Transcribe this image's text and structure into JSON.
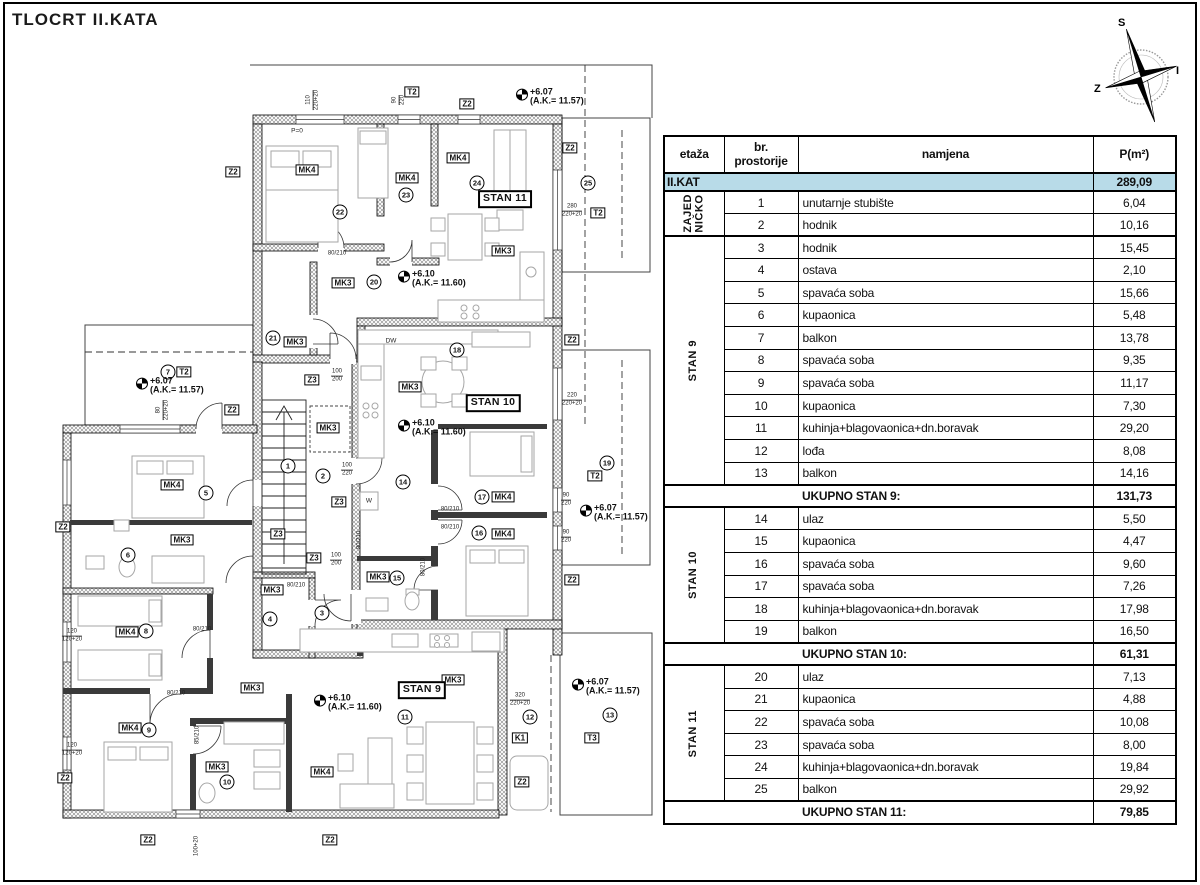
{
  "title": "TLOCRT II.KATA",
  "compass": {
    "north": "S",
    "east": "I",
    "west": "Z"
  },
  "table": {
    "header": {
      "col1": "etaža",
      "col2": "br.\nprostorije",
      "col3": "namjena",
      "col4": "P(m²)"
    },
    "floor_total": {
      "label": "II.KAT",
      "value": "289,09"
    },
    "groups": [
      {
        "label": "ZAJED\nNIČKO",
        "rows": [
          [
            "1",
            "unutarnje stubište",
            "6,04"
          ],
          [
            "2",
            "hodnik",
            "10,16"
          ]
        ]
      },
      {
        "label": "STAN 9",
        "rows": [
          [
            "3",
            "hodnik",
            "15,45"
          ],
          [
            "4",
            "ostava",
            "2,10"
          ],
          [
            "5",
            "spavaća soba",
            "15,66"
          ],
          [
            "6",
            "kupaonica",
            "5,48"
          ],
          [
            "7",
            "balkon",
            "13,78"
          ],
          [
            "8",
            "spavaća soba",
            "9,35"
          ],
          [
            "9",
            "spavaća soba",
            "11,17"
          ],
          [
            "10",
            "kupaonica",
            "7,30"
          ],
          [
            "11",
            "kuhinja+blagovaonica+dn.boravak",
            "29,20"
          ],
          [
            "12",
            "lođa",
            "8,08"
          ],
          [
            "13",
            "balkon",
            "14,16"
          ]
        ],
        "total_label": "UKUPNO STAN 9:",
        "total": "131,73"
      },
      {
        "label": "STAN 10",
        "rows": [
          [
            "14",
            "ulaz",
            "5,50"
          ],
          [
            "15",
            "kupaonica",
            "4,47"
          ],
          [
            "16",
            "spavaća soba",
            "9,60"
          ],
          [
            "17",
            "spavaća soba",
            "7,26"
          ],
          [
            "18",
            "kuhinja+blagovaonica+dn.boravak",
            "17,98"
          ],
          [
            "19",
            "balkon",
            "16,50"
          ]
        ],
        "total_label": "UKUPNO STAN 10:",
        "total": "61,31"
      },
      {
        "label": "STAN 11",
        "rows": [
          [
            "20",
            "ulaz",
            "7,13"
          ],
          [
            "21",
            "kupaonica",
            "4,88"
          ],
          [
            "22",
            "spavaća soba",
            "10,08"
          ],
          [
            "23",
            "spavaća soba",
            "8,00"
          ],
          [
            "24",
            "kuhinja+blagovaonica+dn.boravak",
            "19,84"
          ],
          [
            "25",
            "balkon",
            "29,92"
          ]
        ],
        "total_label": "UKUPNO STAN 11:",
        "total": "79,85"
      }
    ]
  },
  "plan": {
    "highlight_color": "#b8dbe8",
    "boxes": [
      {
        "t": "MK4",
        "x": 307,
        "y": 170
      },
      {
        "t": "MK4",
        "x": 407,
        "y": 178
      },
      {
        "t": "MK4",
        "x": 458,
        "y": 158
      },
      {
        "t": "MK4",
        "x": 172,
        "y": 485
      },
      {
        "t": "MK4",
        "x": 503,
        "y": 497
      },
      {
        "t": "MK4",
        "x": 503,
        "y": 534
      },
      {
        "t": "MK4",
        "x": 127,
        "y": 632
      },
      {
        "t": "MK4",
        "x": 130,
        "y": 728
      },
      {
        "t": "MK4",
        "x": 322,
        "y": 772
      },
      {
        "t": "MK3",
        "x": 503,
        "y": 251
      },
      {
        "t": "MK3",
        "x": 343,
        "y": 283
      },
      {
        "t": "MK3",
        "x": 295,
        "y": 342
      },
      {
        "t": "MK3",
        "x": 410,
        "y": 387
      },
      {
        "t": "MK3",
        "x": 328,
        "y": 428
      },
      {
        "t": "MK3",
        "x": 182,
        "y": 540
      },
      {
        "t": "MK3",
        "x": 272,
        "y": 590
      },
      {
        "t": "MK3",
        "x": 252,
        "y": 688
      },
      {
        "t": "MK3",
        "x": 453,
        "y": 680
      },
      {
        "t": "MK3",
        "x": 217,
        "y": 767
      },
      {
        "t": "MK3",
        "x": 378,
        "y": 577
      },
      {
        "t": "Z2",
        "x": 233,
        "y": 172
      },
      {
        "t": "Z2",
        "x": 467,
        "y": 104
      },
      {
        "t": "Z2",
        "x": 570,
        "y": 148
      },
      {
        "t": "Z2",
        "x": 232,
        "y": 410
      },
      {
        "t": "Z2",
        "x": 63,
        "y": 527
      },
      {
        "t": "Z2",
        "x": 572,
        "y": 340
      },
      {
        "t": "Z2",
        "x": 572,
        "y": 580
      },
      {
        "t": "Z2",
        "x": 65,
        "y": 778
      },
      {
        "t": "Z2",
        "x": 148,
        "y": 840
      },
      {
        "t": "Z2",
        "x": 330,
        "y": 840
      },
      {
        "t": "Z2",
        "x": 522,
        "y": 782
      },
      {
        "t": "Z3",
        "x": 312,
        "y": 380
      },
      {
        "t": "Z3",
        "x": 339,
        "y": 502
      },
      {
        "t": "Z3",
        "x": 278,
        "y": 534
      },
      {
        "t": "Z3",
        "x": 314,
        "y": 558
      },
      {
        "t": "T2",
        "x": 412,
        "y": 92
      },
      {
        "t": "T2",
        "x": 598,
        "y": 213
      },
      {
        "t": "T2",
        "x": 184,
        "y": 372
      },
      {
        "t": "T2",
        "x": 595,
        "y": 476
      },
      {
        "t": "T3",
        "x": 592,
        "y": 738
      },
      {
        "t": "K1",
        "x": 520,
        "y": 738
      },
      {
        "t": "STAN 11",
        "x": 505,
        "y": 199,
        "c": "stanbox"
      },
      {
        "t": "STAN 10",
        "x": 493,
        "y": 403,
        "c": "stanbox"
      },
      {
        "t": "STAN 9",
        "x": 422,
        "y": 690,
        "c": "stanbox"
      },
      {
        "t": "P=0",
        "x": 297,
        "y": 131,
        "c": "tiny"
      },
      {
        "t": "DW",
        "x": 391,
        "y": 341,
        "c": "tiny"
      },
      {
        "t": "W",
        "x": 369,
        "y": 501,
        "c": "tiny"
      }
    ],
    "circles": [
      {
        "n": "1",
        "x": 288,
        "y": 466
      },
      {
        "n": "2",
        "x": 323,
        "y": 476
      },
      {
        "n": "3",
        "x": 322,
        "y": 613
      },
      {
        "n": "4",
        "x": 270,
        "y": 619
      },
      {
        "n": "5",
        "x": 206,
        "y": 493
      },
      {
        "n": "6",
        "x": 128,
        "y": 555
      },
      {
        "n": "7",
        "x": 168,
        "y": 372
      },
      {
        "n": "8",
        "x": 146,
        "y": 631
      },
      {
        "n": "9",
        "x": 149,
        "y": 730
      },
      {
        "n": "10",
        "x": 227,
        "y": 782
      },
      {
        "n": "11",
        "x": 405,
        "y": 717
      },
      {
        "n": "12",
        "x": 530,
        "y": 717
      },
      {
        "n": "13",
        "x": 610,
        "y": 715
      },
      {
        "n": "14",
        "x": 403,
        "y": 482
      },
      {
        "n": "15",
        "x": 397,
        "y": 578
      },
      {
        "n": "16",
        "x": 479,
        "y": 533
      },
      {
        "n": "17",
        "x": 482,
        "y": 497
      },
      {
        "n": "18",
        "x": 457,
        "y": 350
      },
      {
        "n": "19",
        "x": 607,
        "y": 463
      },
      {
        "n": "20",
        "x": 374,
        "y": 282
      },
      {
        "n": "21",
        "x": 273,
        "y": 338
      },
      {
        "n": "22",
        "x": 340,
        "y": 212
      },
      {
        "n": "23",
        "x": 406,
        "y": 195
      },
      {
        "n": "24",
        "x": 477,
        "y": 183
      },
      {
        "n": "25",
        "x": 588,
        "y": 183
      }
    ],
    "elevations": [
      {
        "a": "+6.07",
        "b": "(A.K.= 11.57)",
        "x": 516,
        "y": 97
      },
      {
        "a": "+6.10",
        "b": "(A.K.= 11.60)",
        "x": 398,
        "y": 279
      },
      {
        "a": "+6.07",
        "b": "(A.K.= 11.57)",
        "x": 136,
        "y": 386
      },
      {
        "a": "+6.10",
        "b": "(A.K.= 11.60)",
        "x": 398,
        "y": 428
      },
      {
        "a": "+6.07",
        "b": "(A.K.= 11.57)",
        "x": 580,
        "y": 513
      },
      {
        "a": "+6.10",
        "b": "(A.K.= 11.60)",
        "x": 314,
        "y": 703
      },
      {
        "a": "+6.07",
        "b": "(A.K.= 11.57)",
        "x": 572,
        "y": 687
      }
    ],
    "dims": [
      {
        "a": "280",
        "b": "220+20",
        "x": 572,
        "y": 211
      },
      {
        "a": "220",
        "b": "220+20",
        "x": 572,
        "y": 400
      },
      {
        "a": "90",
        "b": "220",
        "x": 566,
        "y": 500
      },
      {
        "a": "90",
        "b": "220",
        "x": 566,
        "y": 537
      },
      {
        "a": "320",
        "b": "220+20",
        "x": 520,
        "y": 700
      },
      {
        "a": "100",
        "b": "220",
        "x": 347,
        "y": 470
      },
      {
        "a": "100",
        "b": "200",
        "x": 337,
        "y": 376
      },
      {
        "a": "100",
        "b": "200",
        "x": 336,
        "y": 560
      },
      {
        "a": "120",
        "b": "120+20",
        "x": 72,
        "y": 636
      },
      {
        "a": "120",
        "b": "120+20",
        "x": 72,
        "y": 750
      },
      {
        "a": "80",
        "b": "220+20",
        "x": 163,
        "y": 410,
        "r": 1
      },
      {
        "a": "110",
        "b": "220+20",
        "x": 313,
        "y": 100,
        "r": 1
      },
      {
        "a": "90",
        "b": "220",
        "x": 399,
        "y": 100,
        "r": 1
      },
      {
        "a": "100+20",
        "x": 197,
        "y": 846,
        "r": 1
      },
      {
        "a": "80/210",
        "x": 202,
        "y": 630
      },
      {
        "a": "80/210",
        "x": 176,
        "y": 694
      },
      {
        "a": "80/210",
        "x": 296,
        "y": 586
      },
      {
        "a": "80/210",
        "x": 450,
        "y": 510
      },
      {
        "a": "80/210",
        "x": 450,
        "y": 528
      },
      {
        "a": "80/210",
        "x": 424,
        "y": 567,
        "r": 1
      },
      {
        "a": "85/210",
        "x": 198,
        "y": 735,
        "r": 1
      },
      {
        "a": "80/210",
        "x": 337,
        "y": 254
      },
      {
        "a": "80/210",
        "x": 360,
        "y": 540,
        "r": 1
      }
    ]
  }
}
